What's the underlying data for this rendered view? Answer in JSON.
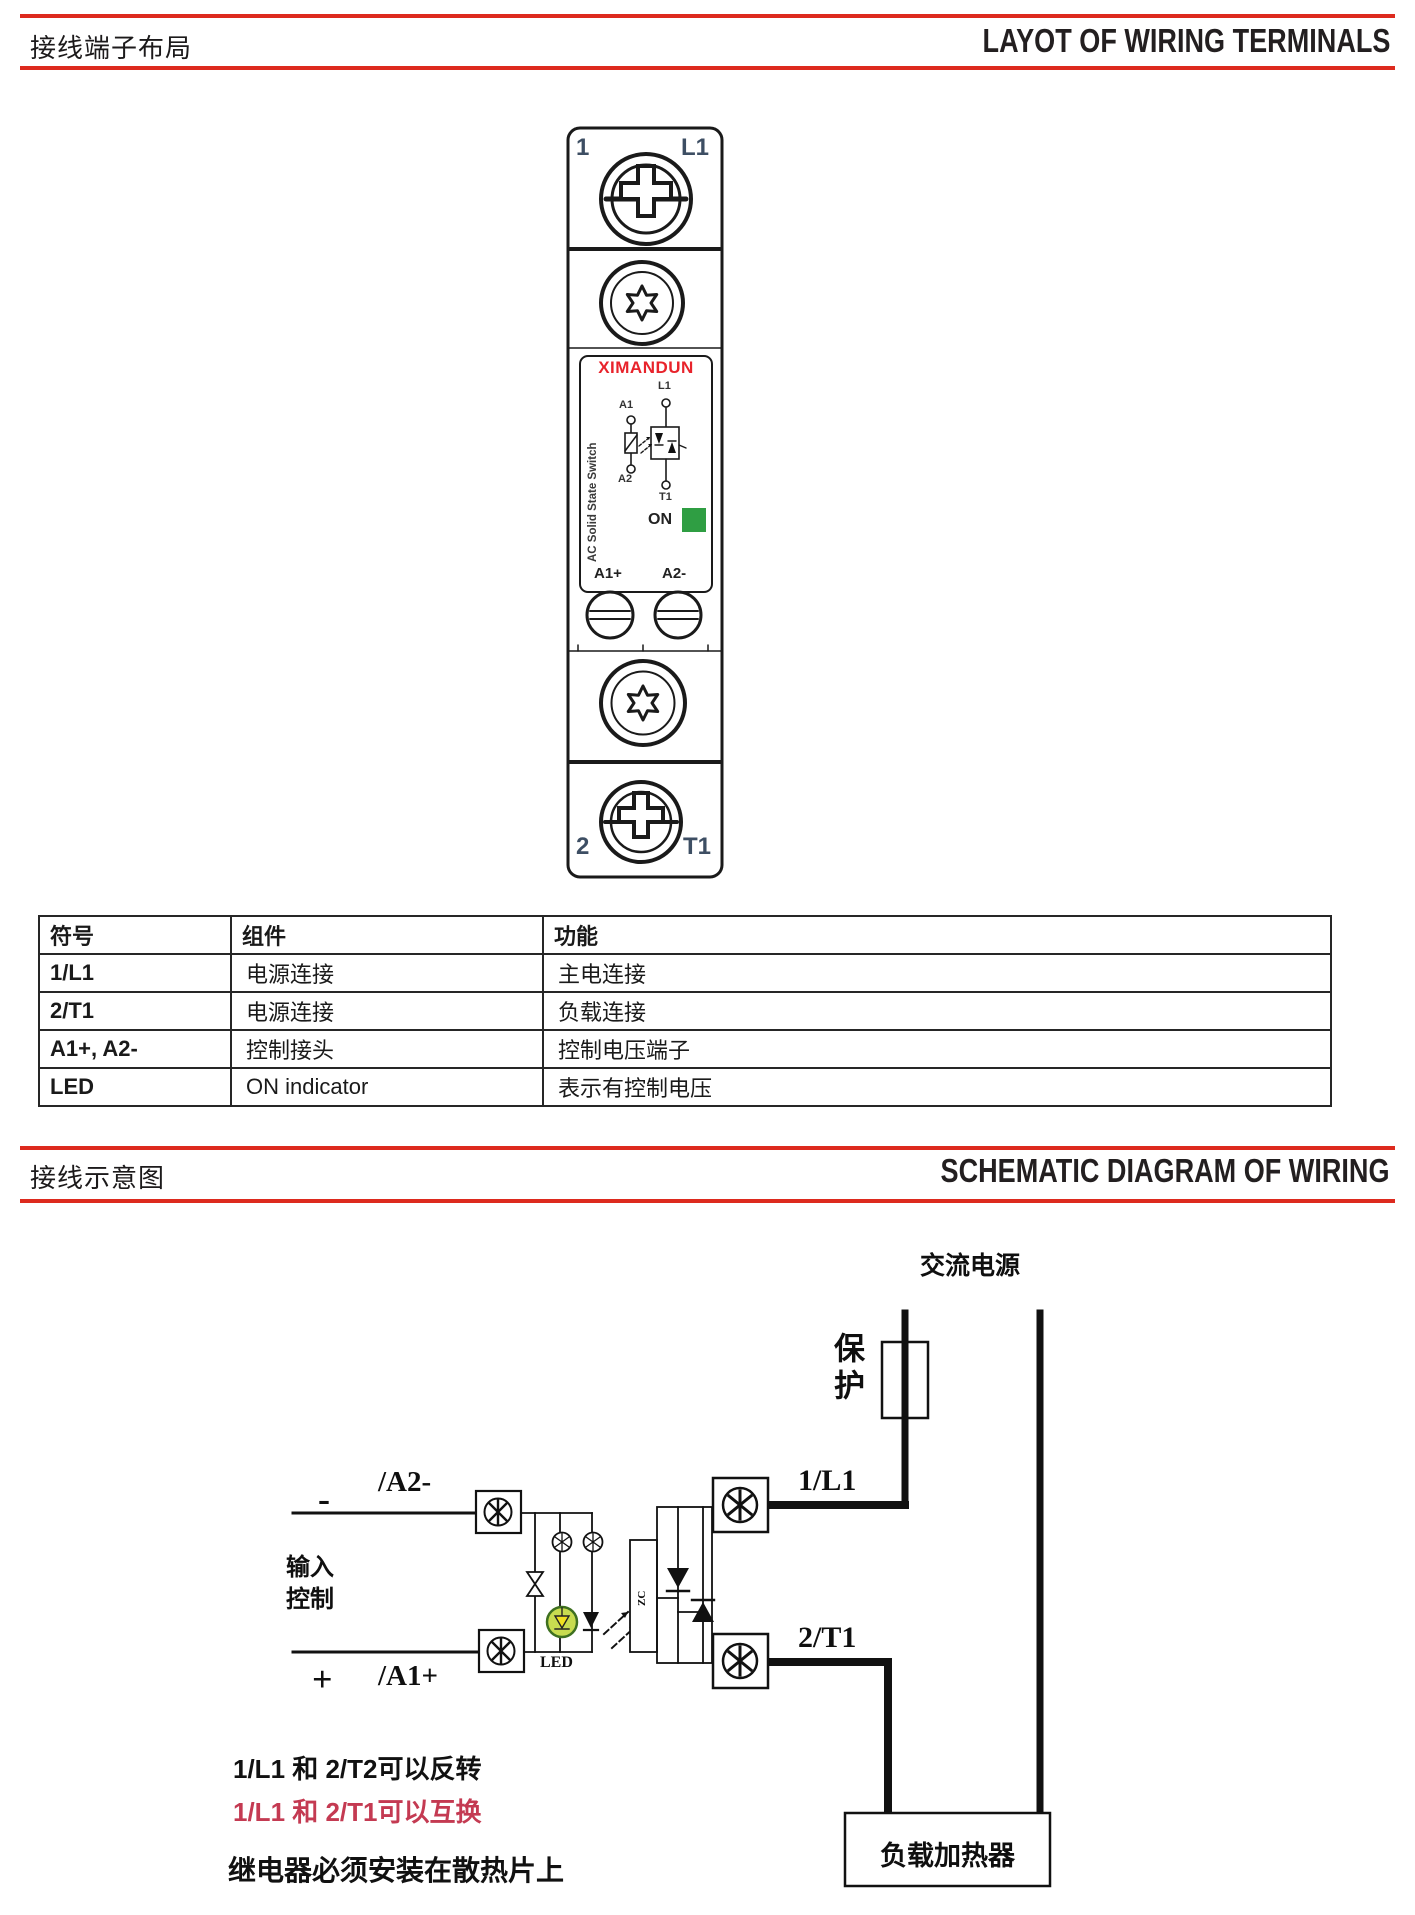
{
  "section1": {
    "title_cn": "接线端子布局",
    "title_en": "LAYOT OF WIRING TERMINALS"
  },
  "section2": {
    "title_cn": "接线示意图",
    "title_en": "SCHEMATIC DIAGRAM OF WIRING"
  },
  "device": {
    "brand": "XIMANDUN",
    "top_left": "1",
    "top_right": "L1",
    "bottom_left": "2",
    "bottom_right": "T1",
    "terminal_a1": "A1+",
    "terminal_a2": "A2-",
    "on_label": "ON",
    "side_text": "AC Solid State Switch",
    "sym_l1": "L1",
    "sym_t1": "T1",
    "sym_a1": "A1",
    "sym_a2": "A2",
    "colors": {
      "brand_red": "#e8232b",
      "on_green": "#2f9e43",
      "corner_label": "#3d4e63"
    }
  },
  "table": {
    "headers": [
      "符号",
      "组件",
      "功能"
    ],
    "rows": [
      [
        "1/L1",
        "电源连接",
        "主电连接"
      ],
      [
        "2/T1",
        "电源连接",
        "负载连接"
      ],
      [
        "A1+, A2-",
        "控制接头",
        "控制电压端子"
      ],
      [
        "LED",
        "ON indicator",
        "表示有控制电压"
      ]
    ]
  },
  "schematic": {
    "ac_power": "交流电源",
    "protection": "保护",
    "terminal_1l1": "1/L1",
    "terminal_2t1": "2/T1",
    "input_label": "输入\n控制",
    "minus": "-",
    "plus": "+",
    "wire_a2": "/A2-",
    "wire_a1": "/A1+",
    "led_label": "LED",
    "zc_label": "ZC",
    "load_label": "负载加热器"
  },
  "notes": {
    "note1": "1/L1 和 2/T2可以反转",
    "note2": "1/L1 和 2/T1可以互换",
    "note3": "继电器必须安装在散热片上",
    "note2_color": "#c43a52"
  },
  "colors": {
    "accent_red": "#dd2a1e"
  }
}
